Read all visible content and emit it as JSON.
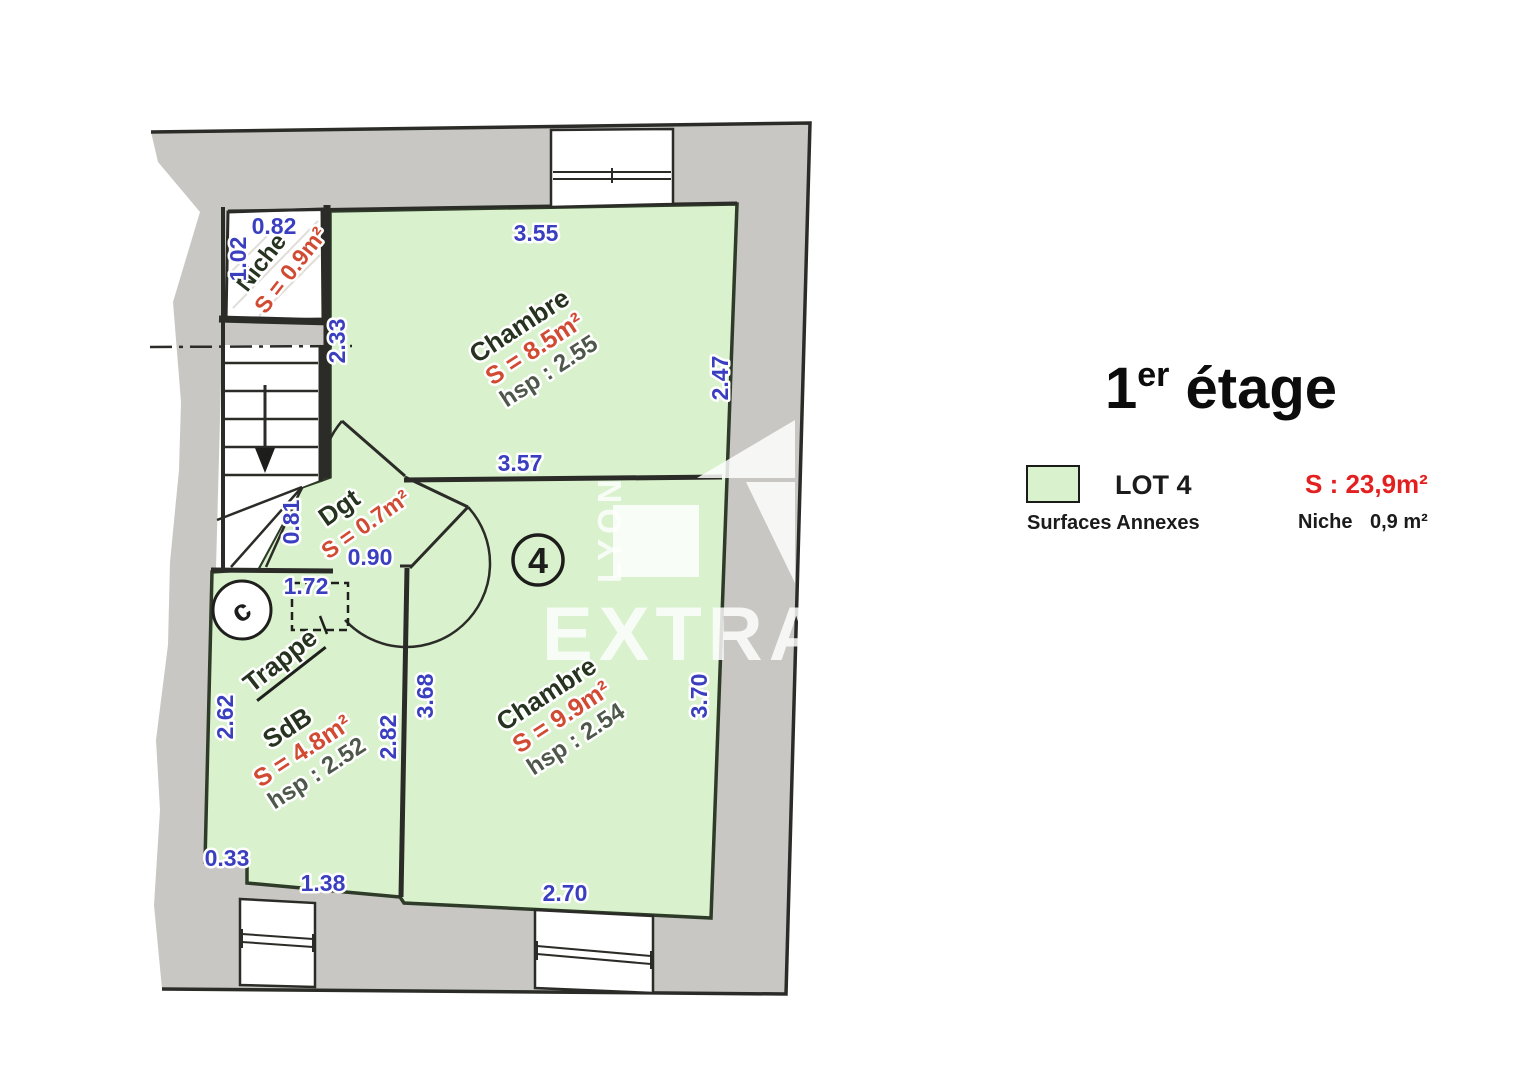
{
  "colors": {
    "wall_gray": "#c8c7c3",
    "room_green": "#d9f2cd",
    "line_dark": "#2b2b27",
    "dim_blue": "#3a3fc0",
    "area_red": "#d14a32",
    "legend_red": "#e41f1f",
    "label_dark": "#26331f",
    "hsp_gray": "#4e584a",
    "hatch_gray": "#e0ded8"
  },
  "title": {
    "number": "1",
    "ordinal": "er",
    "rest": " étage"
  },
  "legend": {
    "lot_label": "LOT 4",
    "lot_area": "S : 23,9m²",
    "annex_title": "Surfaces Annexes",
    "annex_name": "Niche",
    "annex_value": "0,9 m²"
  },
  "rooms": {
    "chambre1": {
      "name": "Chambre",
      "area": "S = 8.5m²",
      "hsp": "hsp : 2.55"
    },
    "chambre2": {
      "name": "Chambre",
      "area": "S = 9.9m²",
      "hsp": "hsp : 2.54"
    },
    "sdb": {
      "name": "SdB",
      "area": "S = 4.8m²",
      "hsp": "hsp : 2.52"
    },
    "dgt": {
      "name": "Dgt",
      "area": "S = 0.7m²"
    },
    "niche": {
      "name": "Niche",
      "area": "S = 0.9m²"
    },
    "trappe_label": "Trappe",
    "conduit_label": "c",
    "lot_number": "4"
  },
  "dims": {
    "niche_width": "0.82",
    "niche_depth": "1.02",
    "chambre1_width": "3.55",
    "chambre1_depth": "2.47",
    "chambre1_bottom": "3.57",
    "stairs_height": "2.33",
    "dgt_height": "0.81",
    "dgt_width": "0.90",
    "trappe_width": "1.72",
    "sdb_left": "2.62",
    "sdb_right": "2.82",
    "sdb_step": "0.33",
    "sdb_bottom": "1.38",
    "chambre2_left": "3.68",
    "chambre2_right": "3.70",
    "chambre2_bottom": "2.70"
  },
  "watermark": {
    "brand": "EXTRAM",
    "city": "LYON"
  }
}
